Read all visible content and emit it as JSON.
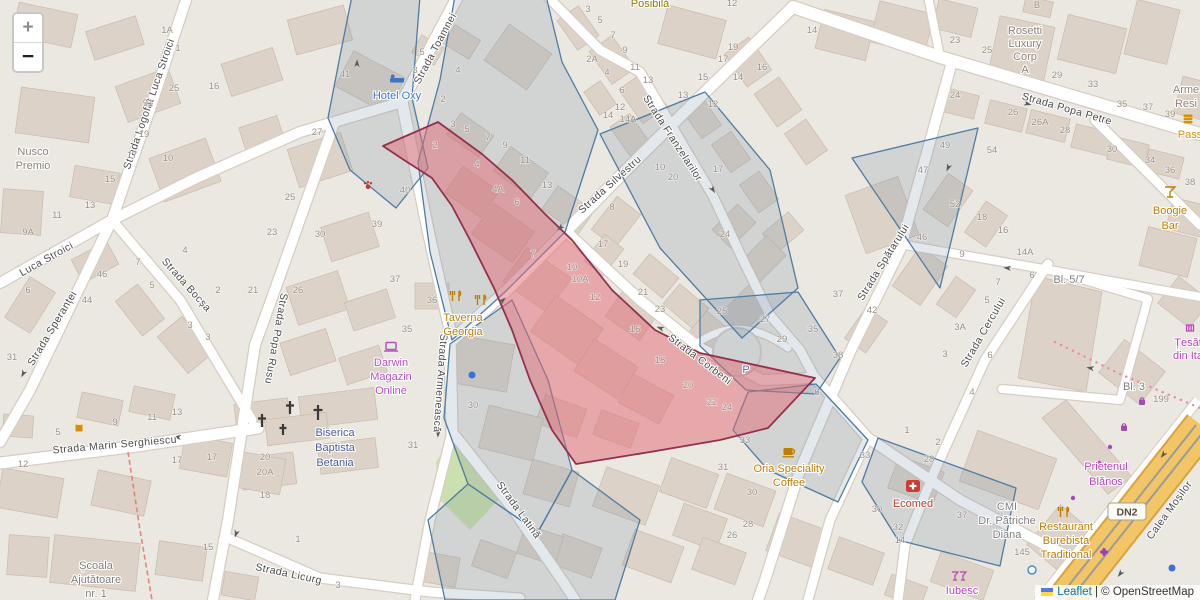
{
  "controls": {
    "zoom_in": "+",
    "zoom_out": "−"
  },
  "attribution": {
    "leaflet": "Leaflet",
    "sep": " | © ",
    "osm": "OpenStreetMap"
  },
  "road_refs": {
    "dn2": "DN2"
  },
  "colors": {
    "selection_fill": "#e06973",
    "selection_stroke": "#93304c",
    "parcel_stroke": "#4e7ca3",
    "major_road": "#f2c566",
    "link": "#0078a8",
    "poi_orange": "#c17d00",
    "poi_magenta": "#bf3ebf",
    "poi_purple": "#b94fc7",
    "poi_blue": "#3f74c4",
    "poi_red": "#c03a31",
    "poi_gray": "#8b8178",
    "church_blue": "#4a5a9c",
    "parking_blue": "#5868b5"
  },
  "street_labels": [
    {
      "t": "Strada Logofăt Luca Stroici",
      "x": 152,
      "y": 105,
      "r": -71
    },
    {
      "t": "Luca Stroici",
      "x": 48,
      "y": 262,
      "r": -29
    },
    {
      "t": "Strada Speranței",
      "x": 55,
      "y": 330,
      "r": -59
    },
    {
      "t": "Strada Bocșa",
      "x": 184,
      "y": 287,
      "r": 48
    },
    {
      "t": "Strada Popa Rusu",
      "x": 273,
      "y": 338,
      "r": 100
    },
    {
      "t": "Strada Toamnei",
      "x": 438,
      "y": 50,
      "r": -62
    },
    {
      "t": "Strada Armenească",
      "x": 437,
      "y": 383,
      "r": 94
    },
    {
      "t": "Strada Silvestru",
      "x": 612,
      "y": 187,
      "r": -42
    },
    {
      "t": "Strada Franzelarilor",
      "x": 670,
      "y": 140,
      "r": 57
    },
    {
      "t": "Strada Popa Petre",
      "x": 1066,
      "y": 112,
      "r": 16
    },
    {
      "t": "Strada Spătarului",
      "x": 886,
      "y": 264,
      "r": -58
    },
    {
      "t": "Strada Cercului",
      "x": 986,
      "y": 334,
      "r": -60
    },
    {
      "t": "Strada Corbeni",
      "x": 698,
      "y": 362,
      "r": 37
    },
    {
      "t": "Strada Marin Serghiescu",
      "x": 115,
      "y": 448,
      "r": -5
    },
    {
      "t": "Strada Licurg",
      "x": 288,
      "y": 577,
      "r": 12
    },
    {
      "t": "Strada Latină",
      "x": 516,
      "y": 512,
      "r": 54
    },
    {
      "t": "Calea Moșilor",
      "x": 1172,
      "y": 512,
      "r": -54,
      "c": "#3f3a33"
    }
  ],
  "pois": [
    {
      "id": "nusco-premio",
      "lines": [
        "Nusco",
        "Premio"
      ],
      "x": 33,
      "y": 155,
      "color": "#8b8178"
    },
    {
      "id": "hotel-oxy",
      "lines": [
        "Hotel Oxy"
      ],
      "x": 397,
      "y": 99,
      "color": "#3f74c4"
    },
    {
      "id": "posibila",
      "lines": [
        "Posibilă"
      ],
      "x": 650,
      "y": 7,
      "color": "#8f7a00"
    },
    {
      "id": "taverna-georgia",
      "lines": [
        "Taverna",
        "Georgia"
      ],
      "x": 463,
      "y": 321,
      "color": "#c17d00"
    },
    {
      "id": "darwin-magazin-online",
      "lines": [
        "Darwin",
        "Magazin",
        "Online"
      ],
      "x": 391,
      "y": 366,
      "color": "#b94fc7"
    },
    {
      "id": "biserica-baptista-betania",
      "lines": [
        "Biserica",
        "Baptista",
        "Betania"
      ],
      "x": 335,
      "y": 436,
      "lh": 15,
      "color": "#4a5a9c"
    },
    {
      "id": "oria-speciality-coffee",
      "lines": [
        "Oria Speciality",
        "Coffee"
      ],
      "x": 789,
      "y": 472,
      "color": "#c17d00"
    },
    {
      "id": "ecomed",
      "lines": [
        "Ecomed"
      ],
      "x": 913,
      "y": 507,
      "color": "#c03a31"
    },
    {
      "id": "cmi-dr-patriche-diana",
      "lines": [
        "CMI",
        "Dr. Pătriche",
        "Diana"
      ],
      "x": 1007,
      "y": 510,
      "color": "#7f7f7f"
    },
    {
      "id": "restaurant-burebista",
      "lines": [
        "Restaurant",
        "Burebista",
        "Traditional"
      ],
      "x": 1066,
      "y": 530,
      "color": "#c17d00"
    },
    {
      "id": "prietenul-blanos",
      "lines": [
        "Prietenul",
        "Blănos"
      ],
      "x": 1106,
      "y": 470,
      "lh": 15,
      "color": "#bf3ebf"
    },
    {
      "id": "boogie-bar",
      "lines": [
        "Boogie",
        "Bar"
      ],
      "x": 1170,
      "y": 214,
      "lh": 15,
      "color": "#c17d00"
    },
    {
      "id": "rosetti-luxury-corp",
      "lines": [
        "Rosetti",
        "Luxury",
        "Corp",
        "A"
      ],
      "x": 1025,
      "y": 34,
      "lh": 13,
      "color": "#8b8178"
    },
    {
      "id": "armen-resid",
      "lines": [
        "Arme",
        "Resi"
      ],
      "x": 1186,
      "y": 93,
      "color": "#8b8178"
    },
    {
      "id": "pass",
      "lines": [
        "Pass"
      ],
      "x": 1190,
      "y": 138,
      "color": "#d79000"
    },
    {
      "id": "iubesc",
      "lines": [
        "Iubesc"
      ],
      "x": 962,
      "y": 594,
      "color": "#bf3ebf"
    },
    {
      "id": "tesaturi",
      "lines": [
        "Țesăt",
        "din Ita"
      ],
      "x": 1188,
      "y": 346,
      "lh": 13,
      "color": "#bf3ebf"
    },
    {
      "id": "scoala-ajutatoare",
      "lines": [
        "Școala",
        "Ajutătoare",
        "nr. 1"
      ],
      "x": 96,
      "y": 569,
      "color": "#7f7f7f"
    },
    {
      "id": "bloc-5-7",
      "lines": [
        "Bl. 5/7"
      ],
      "x": 1069,
      "y": 283,
      "color": "#7f7f7f",
      "size": 11.5
    },
    {
      "id": "bloc-3",
      "lines": [
        "Bl. 3"
      ],
      "x": 1134,
      "y": 390,
      "color": "#7f7f7f",
      "size": 11.5
    },
    {
      "id": "parking",
      "lines": [
        "P"
      ],
      "x": 746,
      "y": 373,
      "color": "#5868b5",
      "size": 17,
      "bold": true
    }
  ],
  "house_numbers": [
    {
      "t": "1A",
      "x": 167,
      "y": 33
    },
    {
      "t": "1",
      "x": 178,
      "y": 51
    },
    {
      "t": "25",
      "x": 174,
      "y": 91
    },
    {
      "t": "91",
      "x": 148,
      "y": 106
    },
    {
      "t": "16",
      "x": 214,
      "y": 89
    },
    {
      "t": "19",
      "x": 144,
      "y": 137
    },
    {
      "t": "17",
      "x": 132,
      "y": 158
    },
    {
      "t": "10",
      "x": 168,
      "y": 161
    },
    {
      "t": "15",
      "x": 110,
      "y": 182
    },
    {
      "t": "13",
      "x": 90,
      "y": 208
    },
    {
      "t": "11",
      "x": 57,
      "y": 218
    },
    {
      "t": "9A",
      "x": 28,
      "y": 235
    },
    {
      "t": "7",
      "x": 138,
      "y": 265
    },
    {
      "t": "46",
      "x": 102,
      "y": 277
    },
    {
      "t": "5",
      "x": 152,
      "y": 288
    },
    {
      "t": "44",
      "x": 87,
      "y": 303
    },
    {
      "t": "6",
      "x": 28,
      "y": 293
    },
    {
      "t": "31",
      "x": 12,
      "y": 360
    },
    {
      "t": "27",
      "x": 317,
      "y": 135
    },
    {
      "t": "25",
      "x": 290,
      "y": 200
    },
    {
      "t": "23",
      "x": 272,
      "y": 235
    },
    {
      "t": "4",
      "x": 185,
      "y": 253
    },
    {
      "t": "2",
      "x": 218,
      "y": 293
    },
    {
      "t": "21",
      "x": 253,
      "y": 293
    },
    {
      "t": "3",
      "x": 190,
      "y": 328
    },
    {
      "t": "3",
      "x": 208,
      "y": 340
    },
    {
      "t": "30",
      "x": 320,
      "y": 237
    },
    {
      "t": "26",
      "x": 298,
      "y": 293
    },
    {
      "t": "40",
      "x": 405,
      "y": 193
    },
    {
      "t": "39",
      "x": 377,
      "y": 227
    },
    {
      "t": "37",
      "x": 395,
      "y": 282
    },
    {
      "t": "35",
      "x": 407,
      "y": 332
    },
    {
      "t": "41",
      "x": 345,
      "y": 77
    },
    {
      "t": "5",
      "x": 422,
      "y": 55
    },
    {
      "t": "3",
      "x": 415,
      "y": 73
    },
    {
      "t": "4",
      "x": 458,
      "y": 73
    },
    {
      "t": "2",
      "x": 443,
      "y": 102
    },
    {
      "t": "3",
      "x": 453,
      "y": 127
    },
    {
      "t": "5",
      "x": 467,
      "y": 132
    },
    {
      "t": "7",
      "x": 488,
      "y": 140
    },
    {
      "t": "9",
      "x": 505,
      "y": 148
    },
    {
      "t": "11",
      "x": 525,
      "y": 163
    },
    {
      "t": "2",
      "x": 435,
      "y": 148
    },
    {
      "t": "4",
      "x": 477,
      "y": 167
    },
    {
      "t": "4A",
      "x": 498,
      "y": 192
    },
    {
      "t": "6",
      "x": 517,
      "y": 205
    },
    {
      "t": "13",
      "x": 547,
      "y": 188
    },
    {
      "t": "8",
      "x": 612,
      "y": 210
    },
    {
      "t": "17",
      "x": 603,
      "y": 247
    },
    {
      "t": "10",
      "x": 660,
      "y": 170
    },
    {
      "t": "20",
      "x": 673,
      "y": 180
    },
    {
      "t": "17",
      "x": 718,
      "y": 172
    },
    {
      "t": "24",
      "x": 725,
      "y": 237
    },
    {
      "t": "7",
      "x": 533,
      "y": 257
    },
    {
      "t": "10",
      "x": 572,
      "y": 270
    },
    {
      "t": "10A",
      "x": 580,
      "y": 282
    },
    {
      "t": "12",
      "x": 595,
      "y": 300
    },
    {
      "t": "19",
      "x": 623,
      "y": 267
    },
    {
      "t": "21",
      "x": 643,
      "y": 295
    },
    {
      "t": "23",
      "x": 660,
      "y": 312
    },
    {
      "t": "25",
      "x": 722,
      "y": 314
    },
    {
      "t": "16",
      "x": 635,
      "y": 332
    },
    {
      "t": "18",
      "x": 660,
      "y": 363
    },
    {
      "t": "20",
      "x": 688,
      "y": 388
    },
    {
      "t": "22",
      "x": 712,
      "y": 405
    },
    {
      "t": "24",
      "x": 727,
      "y": 410
    },
    {
      "t": "27",
      "x": 765,
      "y": 322
    },
    {
      "t": "29",
      "x": 782,
      "y": 342
    },
    {
      "t": "35",
      "x": 813,
      "y": 332
    },
    {
      "t": "37",
      "x": 838,
      "y": 297
    },
    {
      "t": "38",
      "x": 838,
      "y": 358
    },
    {
      "t": "6",
      "x": 817,
      "y": 395
    },
    {
      "t": "33",
      "x": 745,
      "y": 443
    },
    {
      "t": "31",
      "x": 723,
      "y": 470
    },
    {
      "t": "30",
      "x": 752,
      "y": 495
    },
    {
      "t": "28",
      "x": 748,
      "y": 527
    },
    {
      "t": "26",
      "x": 732,
      "y": 538
    },
    {
      "t": "33",
      "x": 865,
      "y": 458
    },
    {
      "t": "1",
      "x": 907,
      "y": 433
    },
    {
      "t": "2",
      "x": 938,
      "y": 445
    },
    {
      "t": "28",
      "x": 929,
      "y": 462
    },
    {
      "t": "30",
      "x": 877,
      "y": 512
    },
    {
      "t": "32",
      "x": 898,
      "y": 530
    },
    {
      "t": "14",
      "x": 900,
      "y": 543
    },
    {
      "t": "37",
      "x": 962,
      "y": 518
    },
    {
      "t": "12",
      "x": 732,
      "y": 6
    },
    {
      "t": "3",
      "x": 588,
      "y": 12
    },
    {
      "t": "5",
      "x": 600,
      "y": 23
    },
    {
      "t": "7",
      "x": 613,
      "y": 38
    },
    {
      "t": "9",
      "x": 625,
      "y": 53
    },
    {
      "t": "2A",
      "x": 592,
      "y": 62
    },
    {
      "t": "4",
      "x": 607,
      "y": 75
    },
    {
      "t": "11",
      "x": 635,
      "y": 70
    },
    {
      "t": "6",
      "x": 622,
      "y": 93
    },
    {
      "t": "13",
      "x": 648,
      "y": 83
    },
    {
      "t": "12",
      "x": 620,
      "y": 110
    },
    {
      "t": "14",
      "x": 608,
      "y": 118
    },
    {
      "t": "14A",
      "x": 628,
      "y": 122
    },
    {
      "t": "13",
      "x": 683,
      "y": 98
    },
    {
      "t": "15",
      "x": 703,
      "y": 80
    },
    {
      "t": "17",
      "x": 723,
      "y": 62
    },
    {
      "t": "19",
      "x": 733,
      "y": 50
    },
    {
      "t": "14",
      "x": 738,
      "y": 80
    },
    {
      "t": "16",
      "x": 762,
      "y": 70
    },
    {
      "t": "12",
      "x": 713,
      "y": 107
    },
    {
      "t": "14",
      "x": 812,
      "y": 33
    },
    {
      "t": "49",
      "x": 945,
      "y": 148
    },
    {
      "t": "47",
      "x": 923,
      "y": 173
    },
    {
      "t": "54",
      "x": 992,
      "y": 153
    },
    {
      "t": "52",
      "x": 955,
      "y": 207
    },
    {
      "t": "18",
      "x": 982,
      "y": 220
    },
    {
      "t": "16",
      "x": 1003,
      "y": 233
    },
    {
      "t": "46",
      "x": 922,
      "y": 240
    },
    {
      "t": "14A",
      "x": 1025,
      "y": 255
    },
    {
      "t": "9",
      "x": 962,
      "y": 257
    },
    {
      "t": "6",
      "x": 1032,
      "y": 278
    },
    {
      "t": "7",
      "x": 998,
      "y": 285
    },
    {
      "t": "5",
      "x": 987,
      "y": 303
    },
    {
      "t": "42",
      "x": 872,
      "y": 313
    },
    {
      "t": "3A",
      "x": 960,
      "y": 330
    },
    {
      "t": "3",
      "x": 945,
      "y": 357
    },
    {
      "t": "6",
      "x": 990,
      "y": 358
    },
    {
      "t": "4",
      "x": 972,
      "y": 395
    },
    {
      "t": "23",
      "x": 955,
      "y": 43
    },
    {
      "t": "25",
      "x": 987,
      "y": 53
    },
    {
      "t": "24",
      "x": 955,
      "y": 98
    },
    {
      "t": "26",
      "x": 1013,
      "y": 115
    },
    {
      "t": "26A",
      "x": 1040,
      "y": 125
    },
    {
      "t": "28",
      "x": 1065,
      "y": 133
    },
    {
      "t": "29",
      "x": 1057,
      "y": 78
    },
    {
      "t": "33",
      "x": 1093,
      "y": 87
    },
    {
      "t": "35",
      "x": 1122,
      "y": 107
    },
    {
      "t": "37",
      "x": 1148,
      "y": 110
    },
    {
      "t": "39",
      "x": 1170,
      "y": 117
    },
    {
      "t": "B",
      "x": 1037,
      "y": 8
    },
    {
      "t": "30",
      "x": 1112,
      "y": 152
    },
    {
      "t": "34",
      "x": 1150,
      "y": 163
    },
    {
      "t": "36",
      "x": 1170,
      "y": 173
    },
    {
      "t": "38",
      "x": 1190,
      "y": 185
    },
    {
      "t": "5",
      "x": 58,
      "y": 435
    },
    {
      "t": "9",
      "x": 115,
      "y": 425
    },
    {
      "t": "11",
      "x": 152,
      "y": 420
    },
    {
      "t": "13",
      "x": 177,
      "y": 415
    },
    {
      "t": "12",
      "x": 23,
      "y": 467
    },
    {
      "t": "17",
      "x": 177,
      "y": 463
    },
    {
      "t": "17",
      "x": 212,
      "y": 460
    },
    {
      "t": "20",
      "x": 265,
      "y": 460
    },
    {
      "t": "20A",
      "x": 265,
      "y": 475
    },
    {
      "t": "18",
      "x": 265,
      "y": 498
    },
    {
      "t": "31",
      "x": 413,
      "y": 448
    },
    {
      "t": "15",
      "x": 208,
      "y": 550
    },
    {
      "t": "1",
      "x": 298,
      "y": 542
    },
    {
      "t": "3",
      "x": 338,
      "y": 588
    },
    {
      "t": "145",
      "x": 1022,
      "y": 555
    },
    {
      "t": "199",
      "x": 1161,
      "y": 402
    },
    {
      "t": "36",
      "x": 432,
      "y": 303
    },
    {
      "t": "30",
      "x": 473,
      "y": 408
    }
  ]
}
